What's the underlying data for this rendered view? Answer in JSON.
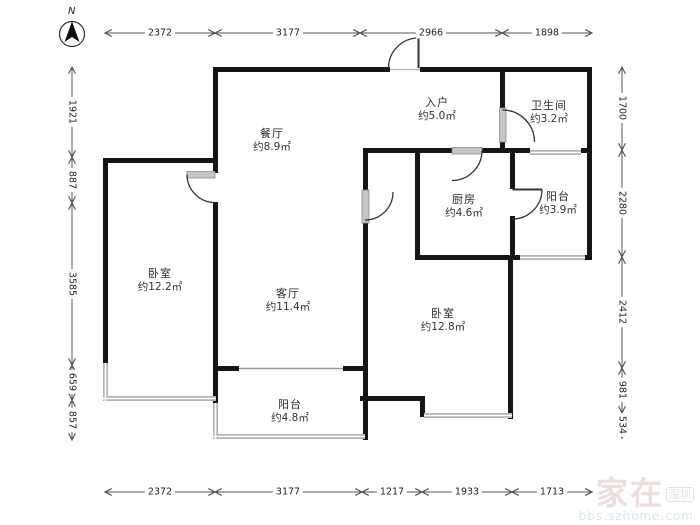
{
  "compass": {
    "label": "N"
  },
  "rooms": [
    {
      "name": "餐厅",
      "area": "约8.9㎡"
    },
    {
      "name": "入户",
      "area": "约5.0㎡"
    },
    {
      "name": "卫生间",
      "area": "约3.2㎡"
    },
    {
      "name": "厨房",
      "area": "约4.6㎡"
    },
    {
      "name": "阳台",
      "area": "约3.9㎡"
    },
    {
      "name": "卧室",
      "area": "约12.2㎡"
    },
    {
      "name": "客厅",
      "area": "约11.4㎡"
    },
    {
      "name": "卧室",
      "area": "约12.8㎡"
    },
    {
      "name": "阳台",
      "area": "约4.8㎡"
    }
  ],
  "dimensions": {
    "top": [
      {
        "value": "2372"
      },
      {
        "value": "3177"
      },
      {
        "value": "2966"
      },
      {
        "value": "1898"
      }
    ],
    "bottom": [
      {
        "value": "2372"
      },
      {
        "value": "3177"
      },
      {
        "value": "1217"
      },
      {
        "value": "1933"
      },
      {
        "value": "1713"
      }
    ],
    "left": [
      {
        "value": "1921"
      },
      {
        "value": "887"
      },
      {
        "value": "3585"
      },
      {
        "value": "659"
      },
      {
        "value": "857"
      }
    ],
    "right": [
      {
        "value": "1700"
      },
      {
        "value": "2280"
      },
      {
        "value": "2412"
      },
      {
        "value": "981"
      },
      {
        "value": "534"
      }
    ]
  },
  "watermark": {
    "brand": "家在",
    "city": "深圳",
    "site": "bbs.szhome.com"
  },
  "colors": {
    "wall": "#151515",
    "window": "#b3b3b3",
    "dimension": "#555555"
  }
}
